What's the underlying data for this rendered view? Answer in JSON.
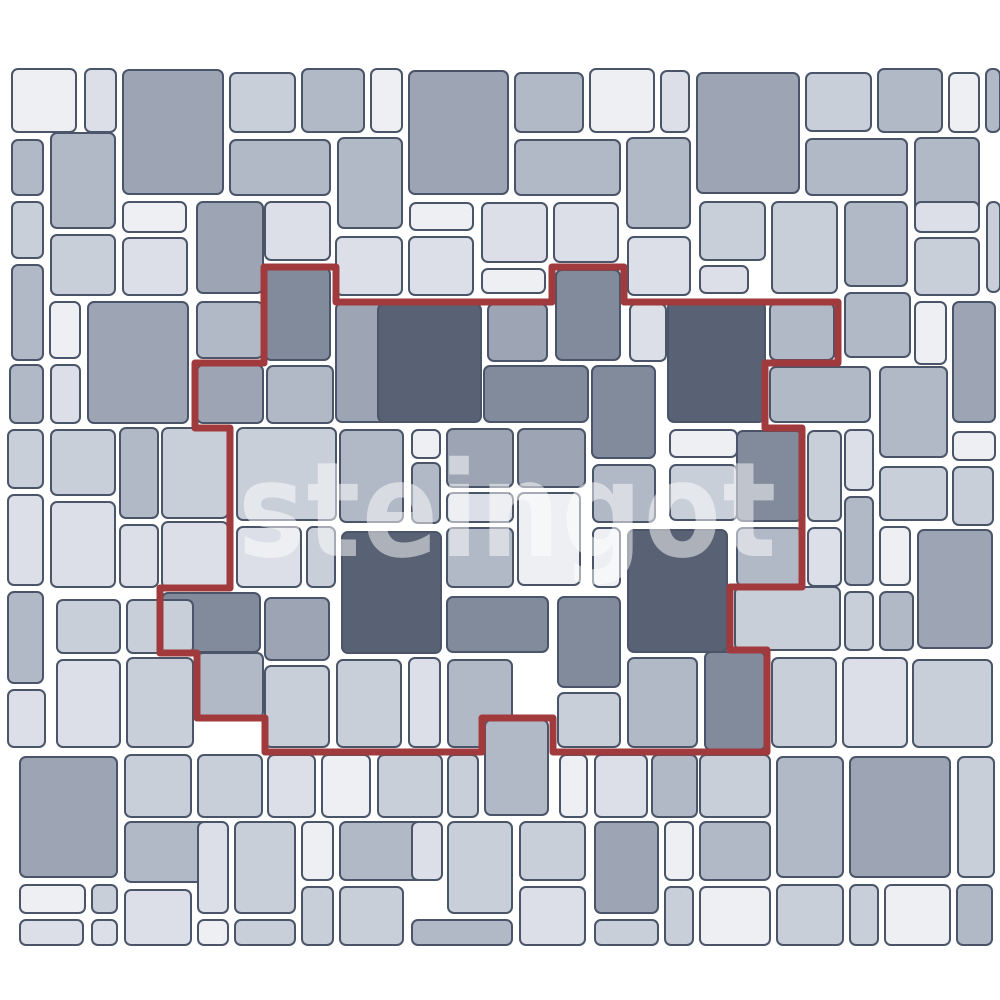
{
  "canvas": {
    "width": 1000,
    "height": 1000
  },
  "watermark": {
    "text": "steingot"
  },
  "palette": {
    "background": "#ffffff",
    "tile_border": "#4b5569",
    "repeat_outline_red": "#a03a3c",
    "tile_colors": [
      "#edeff3",
      "#dcdfe7",
      "#c9cfd9",
      "#b2b9c6",
      "#9da5b4",
      "#828b9c",
      "#596274"
    ]
  },
  "pattern": {
    "description": "multi-size paving stone layout with highlighted repeating unit",
    "tile_gap": 7,
    "corner_radius": 6,
    "tiles": [
      [
        12,
        69,
        64,
        63,
        0
      ],
      [
        85,
        69,
        31,
        63,
        1
      ],
      [
        123,
        70,
        100,
        124,
        4
      ],
      [
        230,
        73,
        65,
        59,
        2
      ],
      [
        302,
        69,
        62,
        63,
        3
      ],
      [
        371,
        69,
        31,
        63,
        0
      ],
      [
        409,
        71,
        99,
        123,
        4
      ],
      [
        515,
        73,
        68,
        59,
        3
      ],
      [
        590,
        69,
        64,
        63,
        0
      ],
      [
        661,
        71,
        28,
        61,
        1
      ],
      [
        697,
        73,
        102,
        120,
        4
      ],
      [
        806,
        73,
        65,
        58,
        2
      ],
      [
        878,
        69,
        64,
        63,
        3
      ],
      [
        949,
        73,
        30,
        59,
        0
      ],
      [
        986,
        69,
        14,
        63,
        3
      ],
      [
        12,
        140,
        31,
        55,
        3
      ],
      [
        51,
        133,
        64,
        95,
        3
      ],
      [
        230,
        140,
        100,
        55,
        3
      ],
      [
        338,
        138,
        64,
        90,
        3
      ],
      [
        515,
        140,
        105,
        55,
        3
      ],
      [
        627,
        138,
        63,
        90,
        3
      ],
      [
        806,
        139,
        101,
        56,
        3
      ],
      [
        915,
        138,
        64,
        90,
        3
      ],
      [
        12,
        202,
        31,
        56,
        2
      ],
      [
        51,
        235,
        64,
        60,
        2
      ],
      [
        12,
        265,
        31,
        95,
        3
      ],
      [
        123,
        202,
        63,
        30,
        0
      ],
      [
        123,
        238,
        64,
        57,
        1
      ],
      [
        197,
        202,
        66,
        91,
        4
      ],
      [
        265,
        202,
        65,
        58,
        1
      ],
      [
        336,
        237,
        66,
        58,
        1
      ],
      [
        410,
        203,
        63,
        27,
        0
      ],
      [
        482,
        203,
        65,
        59,
        1
      ],
      [
        554,
        203,
        64,
        59,
        1
      ],
      [
        409,
        237,
        64,
        58,
        1
      ],
      [
        482,
        269,
        63,
        24,
        0
      ],
      [
        628,
        237,
        62,
        58,
        1
      ],
      [
        700,
        202,
        65,
        58,
        2
      ],
      [
        700,
        266,
        48,
        27,
        1
      ],
      [
        772,
        202,
        65,
        91,
        2
      ],
      [
        845,
        202,
        62,
        84,
        3
      ],
      [
        915,
        202,
        64,
        30,
        1
      ],
      [
        915,
        238,
        64,
        57,
        2
      ],
      [
        987,
        202,
        13,
        90,
        2
      ],
      [
        265,
        268,
        65,
        92,
        5
      ],
      [
        556,
        270,
        64,
        90,
        5
      ],
      [
        88,
        302,
        100,
        121,
        4
      ],
      [
        50,
        302,
        30,
        56,
        0
      ],
      [
        51,
        365,
        29,
        58,
        1
      ],
      [
        197,
        302,
        66,
        56,
        3
      ],
      [
        197,
        365,
        66,
        58,
        4
      ],
      [
        267,
        366,
        66,
        57,
        3
      ],
      [
        336,
        303,
        64,
        119,
        4
      ],
      [
        378,
        304,
        103,
        118,
        6
      ],
      [
        488,
        304,
        59,
        57,
        4
      ],
      [
        484,
        366,
        104,
        56,
        5
      ],
      [
        592,
        366,
        63,
        92,
        5
      ],
      [
        630,
        304,
        36,
        57,
        1
      ],
      [
        668,
        302,
        97,
        120,
        6
      ],
      [
        770,
        303,
        64,
        57,
        3
      ],
      [
        447,
        429,
        66,
        58,
        4
      ],
      [
        518,
        429,
        67,
        58,
        4
      ],
      [
        593,
        465,
        62,
        57,
        3
      ],
      [
        447,
        493,
        66,
        29,
        1
      ],
      [
        518,
        493,
        62,
        92,
        0
      ],
      [
        447,
        528,
        66,
        59,
        3
      ],
      [
        593,
        528,
        27,
        59,
        0
      ],
      [
        628,
        530,
        99,
        122,
        6
      ],
      [
        447,
        597,
        101,
        55,
        5
      ],
      [
        558,
        597,
        62,
        90,
        5
      ],
      [
        670,
        430,
        67,
        27,
        0
      ],
      [
        670,
        465,
        67,
        55,
        2
      ],
      [
        737,
        431,
        65,
        90,
        5
      ],
      [
        737,
        528,
        65,
        58,
        3
      ],
      [
        705,
        652,
        60,
        98,
        5
      ],
      [
        237,
        428,
        99,
        92,
        2
      ],
      [
        237,
        527,
        64,
        60,
        1
      ],
      [
        307,
        527,
        28,
        60,
        2
      ],
      [
        342,
        532,
        99,
        121,
        6
      ],
      [
        340,
        430,
        63,
        92,
        3
      ],
      [
        412,
        430,
        28,
        28,
        0
      ],
      [
        412,
        463,
        28,
        60,
        3
      ],
      [
        162,
        593,
        98,
        59,
        5
      ],
      [
        197,
        653,
        66,
        65,
        3
      ],
      [
        265,
        598,
        64,
        62,
        4
      ],
      [
        265,
        666,
        64,
        81,
        2
      ],
      [
        337,
        660,
        64,
        87,
        2
      ],
      [
        409,
        658,
        31,
        89,
        1
      ],
      [
        448,
        660,
        64,
        87,
        3
      ],
      [
        558,
        693,
        62,
        54,
        2
      ],
      [
        628,
        658,
        69,
        89,
        3
      ],
      [
        10,
        365,
        33,
        58,
        3
      ],
      [
        8,
        430,
        35,
        58,
        2
      ],
      [
        8,
        495,
        35,
        90,
        1
      ],
      [
        8,
        592,
        35,
        91,
        3
      ],
      [
        8,
        690,
        37,
        57,
        1
      ],
      [
        51,
        430,
        64,
        65,
        2
      ],
      [
        51,
        502,
        64,
        85,
        1
      ],
      [
        120,
        428,
        38,
        90,
        3
      ],
      [
        120,
        525,
        38,
        62,
        1
      ],
      [
        162,
        428,
        66,
        90,
        2
      ],
      [
        162,
        522,
        66,
        66,
        1
      ],
      [
        57,
        600,
        63,
        53,
        2
      ],
      [
        127,
        600,
        66,
        53,
        2
      ],
      [
        57,
        660,
        63,
        87,
        1
      ],
      [
        127,
        658,
        66,
        89,
        2
      ],
      [
        845,
        293,
        65,
        64,
        3
      ],
      [
        915,
        302,
        31,
        62,
        0
      ],
      [
        953,
        302,
        42,
        120,
        4
      ],
      [
        770,
        367,
        100,
        55,
        3
      ],
      [
        880,
        367,
        67,
        90,
        3
      ],
      [
        808,
        431,
        33,
        90,
        2
      ],
      [
        845,
        430,
        28,
        60,
        1
      ],
      [
        953,
        432,
        42,
        28,
        0
      ],
      [
        880,
        467,
        67,
        53,
        2
      ],
      [
        953,
        467,
        40,
        58,
        2
      ],
      [
        845,
        497,
        28,
        88,
        3
      ],
      [
        880,
        527,
        30,
        58,
        0
      ],
      [
        918,
        530,
        74,
        118,
        4
      ],
      [
        808,
        528,
        33,
        58,
        1
      ],
      [
        845,
        592,
        28,
        58,
        2
      ],
      [
        880,
        592,
        33,
        58,
        3
      ],
      [
        735,
        587,
        105,
        63,
        2
      ],
      [
        772,
        658,
        64,
        89,
        2
      ],
      [
        843,
        658,
        64,
        89,
        1
      ],
      [
        913,
        660,
        79,
        87,
        2
      ],
      [
        700,
        755,
        70,
        62,
        2
      ],
      [
        700,
        822,
        70,
        58,
        3
      ],
      [
        777,
        757,
        66,
        120,
        3
      ],
      [
        850,
        757,
        100,
        120,
        4
      ],
      [
        958,
        757,
        36,
        120,
        2
      ],
      [
        700,
        887,
        70,
        58,
        0
      ],
      [
        777,
        885,
        66,
        60,
        2
      ],
      [
        850,
        885,
        28,
        60,
        2
      ],
      [
        885,
        885,
        65,
        60,
        0
      ],
      [
        957,
        885,
        35,
        60,
        3
      ],
      [
        20,
        757,
        97,
        120,
        4
      ],
      [
        125,
        755,
        66,
        62,
        2
      ],
      [
        198,
        755,
        64,
        62,
        2
      ],
      [
        125,
        822,
        102,
        60,
        3
      ],
      [
        235,
        822,
        60,
        91,
        2
      ],
      [
        20,
        885,
        65,
        28,
        0
      ],
      [
        92,
        885,
        25,
        28,
        2
      ],
      [
        20,
        920,
        63,
        25,
        1
      ],
      [
        92,
        920,
        25,
        25,
        1
      ],
      [
        125,
        890,
        66,
        55,
        1
      ],
      [
        198,
        822,
        30,
        91,
        1
      ],
      [
        235,
        920,
        60,
        25,
        2
      ],
      [
        198,
        920,
        30,
        25,
        0
      ],
      [
        268,
        755,
        47,
        62,
        1
      ],
      [
        322,
        755,
        48,
        62,
        0
      ],
      [
        302,
        822,
        31,
        58,
        0
      ],
      [
        302,
        887,
        31,
        58,
        2
      ],
      [
        340,
        822,
        100,
        58,
        3
      ],
      [
        378,
        755,
        64,
        62,
        2
      ],
      [
        448,
        755,
        30,
        62,
        2
      ],
      [
        485,
        720,
        63,
        95,
        3
      ],
      [
        340,
        887,
        63,
        58,
        2
      ],
      [
        412,
        822,
        30,
        58,
        1
      ],
      [
        412,
        920,
        100,
        25,
        3
      ],
      [
        448,
        822,
        64,
        91,
        2
      ],
      [
        520,
        822,
        65,
        58,
        2
      ],
      [
        520,
        887,
        65,
        58,
        1
      ],
      [
        560,
        755,
        27,
        62,
        0
      ],
      [
        595,
        755,
        52,
        62,
        1
      ],
      [
        652,
        755,
        45,
        62,
        3
      ],
      [
        595,
        822,
        63,
        91,
        4
      ],
      [
        595,
        920,
        63,
        25,
        2
      ],
      [
        665,
        822,
        28,
        58,
        0
      ],
      [
        665,
        887,
        28,
        58,
        2
      ]
    ],
    "repeat_outline": {
      "stroke_width": 7,
      "points": [
        [
          264,
          267
        ],
        [
          336,
          267
        ],
        [
          336,
          302
        ],
        [
          552,
          302
        ],
        [
          552,
          267
        ],
        [
          624,
          267
        ],
        [
          624,
          302
        ],
        [
          838,
          302
        ],
        [
          838,
          363
        ],
        [
          765,
          363
        ],
        [
          765,
          428
        ],
        [
          802,
          428
        ],
        [
          802,
          587
        ],
        [
          730,
          587
        ],
        [
          730,
          650
        ],
        [
          767,
          650
        ],
        [
          767,
          752
        ],
        [
          553,
          752
        ],
        [
          553,
          718
        ],
        [
          482,
          718
        ],
        [
          482,
          752
        ],
        [
          265,
          752
        ],
        [
          265,
          718
        ],
        [
          197,
          718
        ],
        [
          197,
          653
        ],
        [
          160,
          653
        ],
        [
          160,
          588
        ],
        [
          230,
          588
        ],
        [
          230,
          428
        ],
        [
          195,
          428
        ],
        [
          195,
          363
        ],
        [
          264,
          363
        ]
      ]
    }
  }
}
